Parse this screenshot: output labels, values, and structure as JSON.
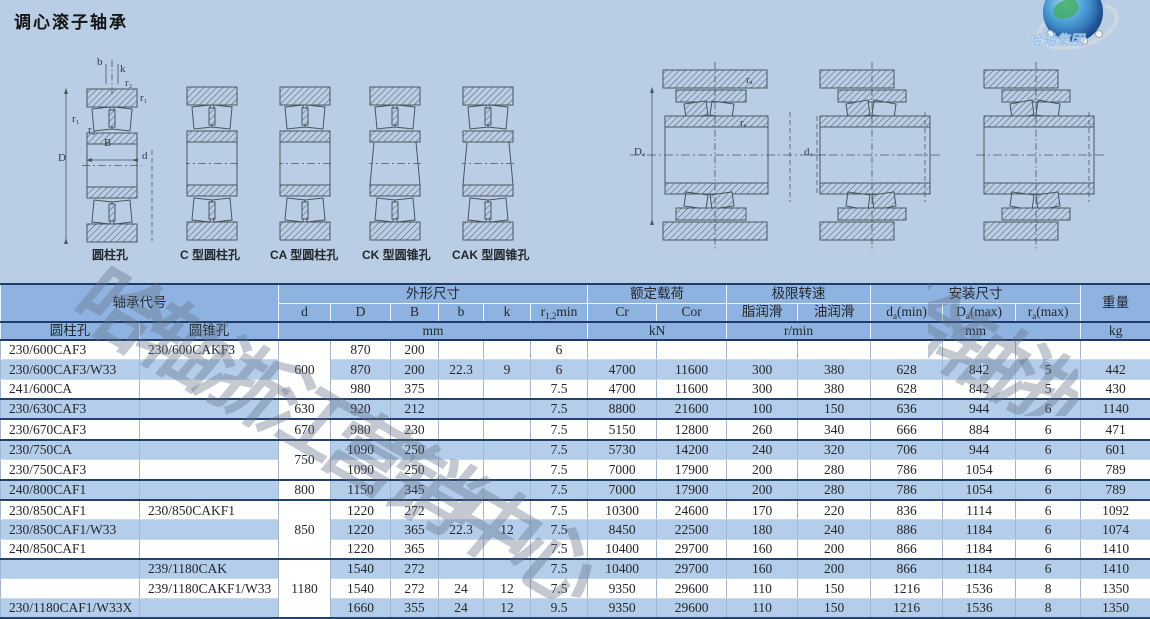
{
  "page": {
    "title": "调心滚子轴承",
    "watermark": "哈轴浙江营销中心"
  },
  "logo": {
    "company": "哈轴集团"
  },
  "diagrams": {
    "labels": [
      "圆柱孔",
      "C 型圆柱孔",
      "CA 型圆柱孔",
      "CK 型圆锥孔",
      "CAK 型圆锥孔"
    ],
    "dims": {
      "b": "b",
      "k": "k",
      "r1": "r₁",
      "r2": "r₂",
      "B": "B",
      "D": "D",
      "d": "d",
      "Da": "Dₐ",
      "ra": "rₐ",
      "da": "dₐ"
    }
  },
  "table": {
    "header": {
      "designation": "轴承代号",
      "bore_cyl": "圆柱孔",
      "bore_taper": "圆锥孔",
      "dims_group": "外形尺寸",
      "d": "d",
      "D": "D",
      "B": "B",
      "b": "b",
      "k": "k",
      "r12": {
        "pre": "r",
        "sub": "1,2",
        "post": "min"
      },
      "load_group": "额定载荷",
      "cr": "Cr",
      "cor": "Cor",
      "speed_group": "极限转速",
      "grease": "脂润滑",
      "oil": "油润滑",
      "mount_group": "安装尺寸",
      "da": {
        "pre": "d",
        "sub": "a",
        "post": "(min)"
      },
      "Da": {
        "pre": "D",
        "sub": "a",
        "post": "(max)"
      },
      "ra": {
        "pre": "r",
        "sub": "a",
        "post": "(max)"
      },
      "weight": "重量",
      "unit_mm": "mm",
      "unit_kn": "kN",
      "unit_rpm": "r/min",
      "unit_mm2": "mm",
      "unit_kg": "kg"
    },
    "rows": [
      {
        "cyl": "230/600CAF3",
        "taper": "230/600CAKF3",
        "d": "600",
        "d_span": 3,
        "cells": [
          "870",
          "200",
          "",
          "",
          "6",
          "",
          "",
          "",
          "",
          "",
          "",
          "",
          ""
        ]
      },
      {
        "cyl": "230/600CAF3/W33",
        "taper": "",
        "cells": [
          "870",
          "200",
          "22.3",
          "9",
          "6",
          "4700",
          "11600",
          "300",
          "380",
          "628",
          "842",
          "5",
          "442"
        ]
      },
      {
        "cyl": "241/600CA",
        "taper": "",
        "group_end": true,
        "cells": [
          "980",
          "375",
          "",
          "",
          "7.5",
          "4700",
          "11600",
          "300",
          "380",
          "628",
          "842",
          "5",
          "430"
        ]
      },
      {
        "cyl": "230/630CAF3",
        "taper": "",
        "d": "630",
        "d_span": 1,
        "group_end": true,
        "cells": [
          "920",
          "212",
          "",
          "",
          "7.5",
          "8800",
          "21600",
          "100",
          "150",
          "636",
          "944",
          "6",
          "1140"
        ]
      },
      {
        "cyl": "230/670CAF3",
        "taper": "",
        "d": "670",
        "d_span": 1,
        "group_end": true,
        "cells": [
          "980",
          "230",
          "",
          "",
          "7.5",
          "5150",
          "12800",
          "260",
          "340",
          "666",
          "884",
          "6",
          "471"
        ]
      },
      {
        "cyl": "230/750CA",
        "taper": "",
        "d": "750",
        "d_span": 2,
        "cells": [
          "1090",
          "250",
          "",
          "",
          "7.5",
          "5730",
          "14200",
          "240",
          "320",
          "706",
          "944",
          "6",
          "601"
        ]
      },
      {
        "cyl": "230/750CAF3",
        "taper": "",
        "group_end": true,
        "cells": [
          "1090",
          "250",
          "",
          "",
          "7.5",
          "7000",
          "17900",
          "200",
          "280",
          "786",
          "1054",
          "6",
          "789"
        ]
      },
      {
        "cyl": "240/800CAF1",
        "taper": "",
        "d": "800",
        "d_span": 1,
        "group_end": true,
        "cells": [
          "1150",
          "345",
          "",
          "",
          "7.5",
          "7000",
          "17900",
          "200",
          "280",
          "786",
          "1054",
          "6",
          "789"
        ]
      },
      {
        "cyl": "230/850CAF1",
        "taper": "230/850CAKF1",
        "d": "850",
        "d_span": 3,
        "cells": [
          "1220",
          "272",
          "",
          "",
          "7.5",
          "10300",
          "24600",
          "170",
          "220",
          "836",
          "1114",
          "6",
          "1092"
        ]
      },
      {
        "cyl": "230/850CAF1/W33",
        "taper": "",
        "cells": [
          "1220",
          "365",
          "22.3",
          "12",
          "7.5",
          "8450",
          "22500",
          "180",
          "240",
          "886",
          "1184",
          "6",
          "1074"
        ]
      },
      {
        "cyl": "240/850CAF1",
        "taper": "",
        "group_end": true,
        "cells": [
          "1220",
          "365",
          "",
          "",
          "7.5",
          "10400",
          "29700",
          "160",
          "200",
          "866",
          "1184",
          "6",
          "1410"
        ]
      },
      {
        "cyl": "",
        "taper": "239/1180CAK",
        "d": "1180",
        "d_span": 3,
        "cells": [
          "1540",
          "272",
          "",
          "",
          "7.5",
          "10400",
          "29700",
          "160",
          "200",
          "866",
          "1184",
          "6",
          "1410"
        ]
      },
      {
        "cyl": "",
        "taper": "239/1180CAKF1/W33",
        "cells": [
          "1540",
          "272",
          "24",
          "12",
          "7.5",
          "9350",
          "29600",
          "110",
          "150",
          "1216",
          "1536",
          "8",
          "1350"
        ]
      },
      {
        "cyl": "230/1180CAF1/W33X",
        "taper": "",
        "group_end": true,
        "cells": [
          "1660",
          "355",
          "24",
          "12",
          "9.5",
          "9350",
          "29600",
          "110",
          "150",
          "1216",
          "1536",
          "8",
          "1350"
        ]
      }
    ]
  }
}
